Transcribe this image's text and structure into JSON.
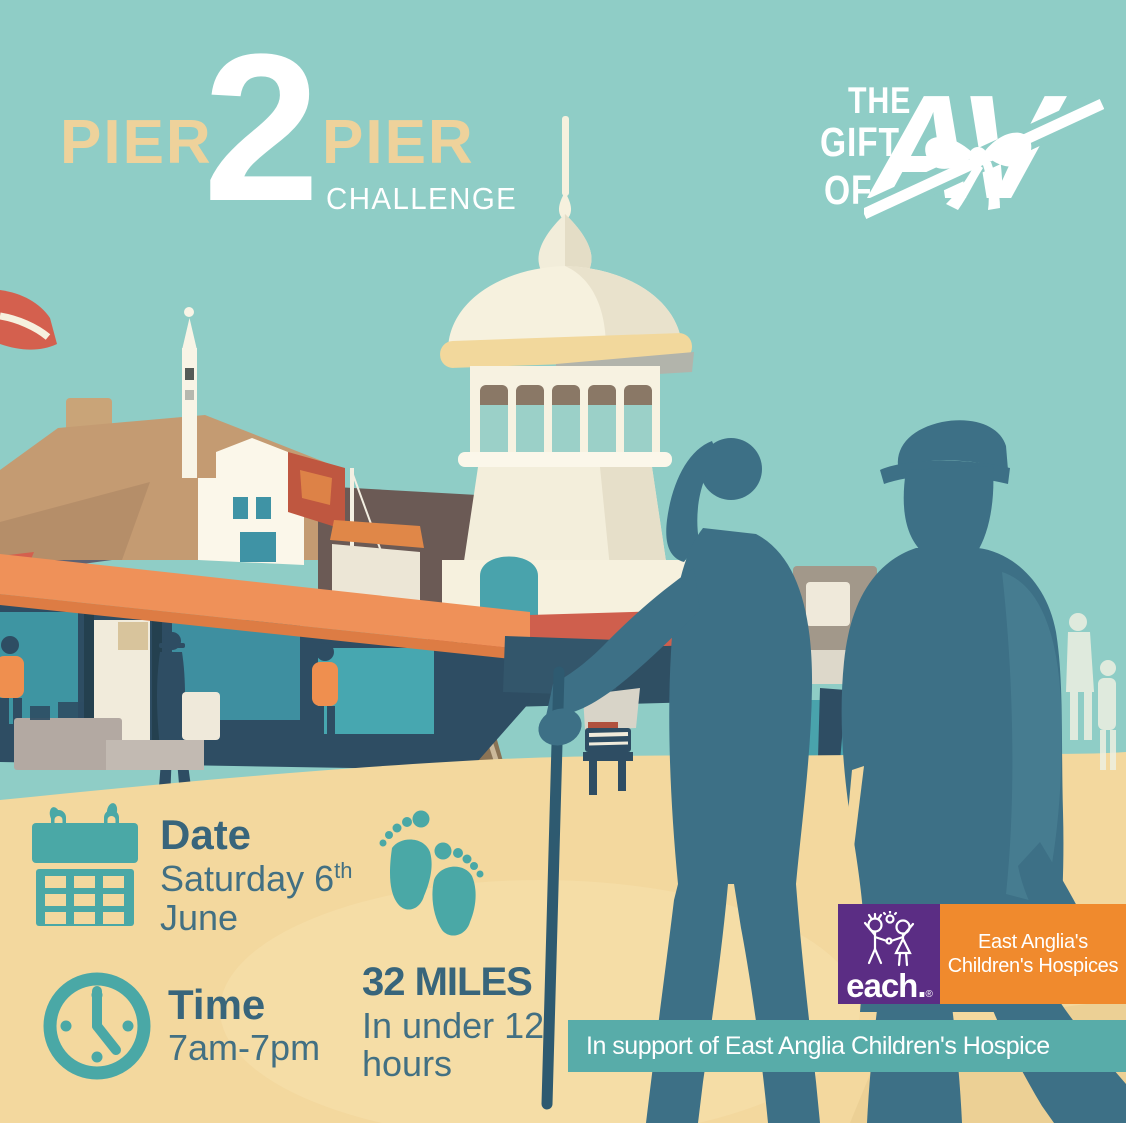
{
  "palette": {
    "sky_teal": "#8fcdc6",
    "sand": "#f3d89e",
    "silhouette_teal": "#3d7086",
    "icon_teal": "#4aa8a6",
    "heading_blue": "#38657b",
    "body_blue": "#427083",
    "logo_tan": "#eed29b",
    "white": "#ffffff",
    "banner_teal": "#58aca9",
    "each_purple": "#5b2d84",
    "each_orange": "#f08a2d",
    "coral_red": "#d4604e",
    "awning_orange": "#ef9159",
    "storefront_navy": "#2e4d63",
    "cream": "#f6f1de"
  },
  "event_logo": {
    "word_left": "PIER",
    "number": "2",
    "word_right": "PIER",
    "subtitle": "CHALLENGE"
  },
  "brand_logo": {
    "line1": "THE",
    "line2": "GIFT",
    "line3": "OF",
    "monogram": "AV"
  },
  "event_details": {
    "date": {
      "label": "Date",
      "day": "Saturday 6",
      "ordinal": "th",
      "month": "June"
    },
    "time": {
      "label": "Time",
      "value": "7am-7pm"
    },
    "distance": {
      "value": "32 MILES",
      "condition_line1": "In under 12",
      "condition_line2": "hours"
    }
  },
  "charity": {
    "each_wordmark": "each.",
    "registered_mark": "®",
    "name_line1": "East Anglia's",
    "name_line2": "Children's Hospices",
    "support_banner": "In support of East Anglia Children's Hospice"
  }
}
